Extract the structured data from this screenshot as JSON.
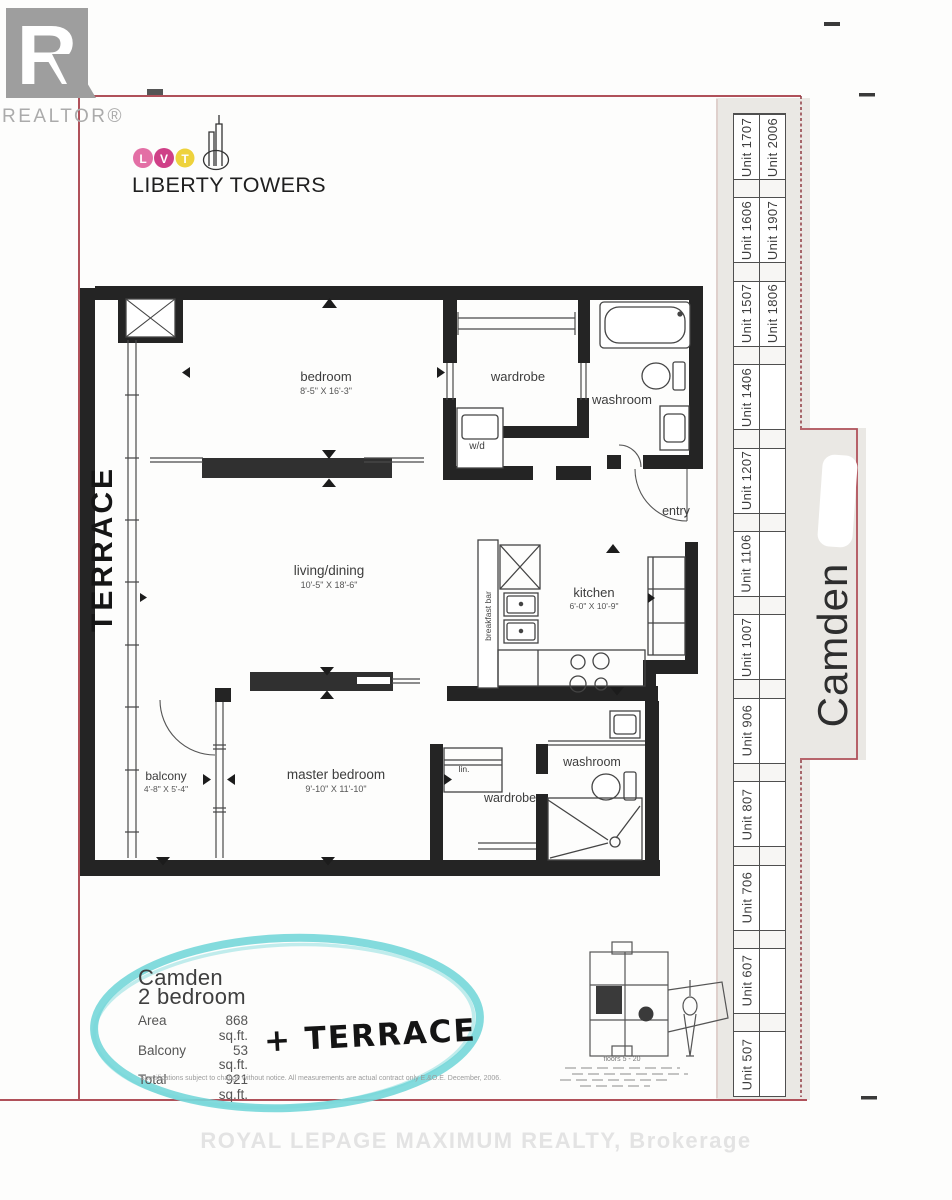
{
  "page": {
    "realtor_wordmark": "REALTOR®",
    "watermark": "ROYAL LEPAGE MAXIMUM REALTY, Brokerage"
  },
  "branding": {
    "letters": [
      "L",
      "V",
      "T"
    ],
    "name": "LIBERTY TOWERS"
  },
  "plan": {
    "terrace_note": "TERRACE",
    "bedroom": {
      "label": "bedroom",
      "dims": "8'-5\" X 16'-3\""
    },
    "wardrobe1": {
      "label": "wardrobe"
    },
    "washroom1": {
      "label": "washroom"
    },
    "wd": {
      "label": "w/d"
    },
    "living": {
      "label": "living/dining",
      "dims": "10'-5\" X 18'-6\""
    },
    "breakfast_bar": {
      "label": "breakfast bar"
    },
    "kitchen": {
      "label": "kitchen",
      "dims": "6'-0\" X 10'-9\""
    },
    "entry": {
      "label": "entry"
    },
    "balcony": {
      "label": "balcony",
      "dims": "4'-8\" X 5'-4\""
    },
    "master_bedroom": {
      "label": "master bedroom",
      "dims": "9'-10\" X 11'-10\""
    },
    "linen": {
      "label": "lin."
    },
    "wardrobe2": {
      "label": "wardrobe"
    },
    "washroom2": {
      "label": "washroom"
    }
  },
  "summary": {
    "name": "Camden",
    "type": "2 bedroom",
    "area_label": "Area",
    "area_value": "868 sq.ft.",
    "balcony_label": "Balcony",
    "balcony_value": "53 sq.ft.",
    "total_label": "Total",
    "total_value": "921 sq.ft.",
    "handwritten_note": "+ TERRACE",
    "disclaimer": "Specifications subject to change without notice. All measurements are actual contract only E.&O.E. December, 2006."
  },
  "key_plan": {
    "caption": "floors 5 - 20"
  },
  "sidebar": {
    "model_name": "Camden",
    "units_col1": [
      "Unit 1707",
      "Unit 1606",
      "Unit 1507",
      "Unit 1406",
      "Unit 1207",
      "Unit 1106",
      "Unit 1007",
      "Unit 906",
      "Unit 807",
      "Unit 706",
      "Unit 607",
      "Unit 507"
    ],
    "units_col2": [
      "Unit 2006",
      "Unit 1907",
      "Unit 1806",
      "",
      "",
      "",
      "",
      "",
      "",
      "",
      "",
      ""
    ]
  },
  "colors": {
    "accent_red": "#b0515a",
    "highlight_cyan": "#76d7d9",
    "lvt_pink": "#e36fa5",
    "lvt_magenta": "#cf3f87",
    "lvt_yellow": "#eed23c"
  }
}
